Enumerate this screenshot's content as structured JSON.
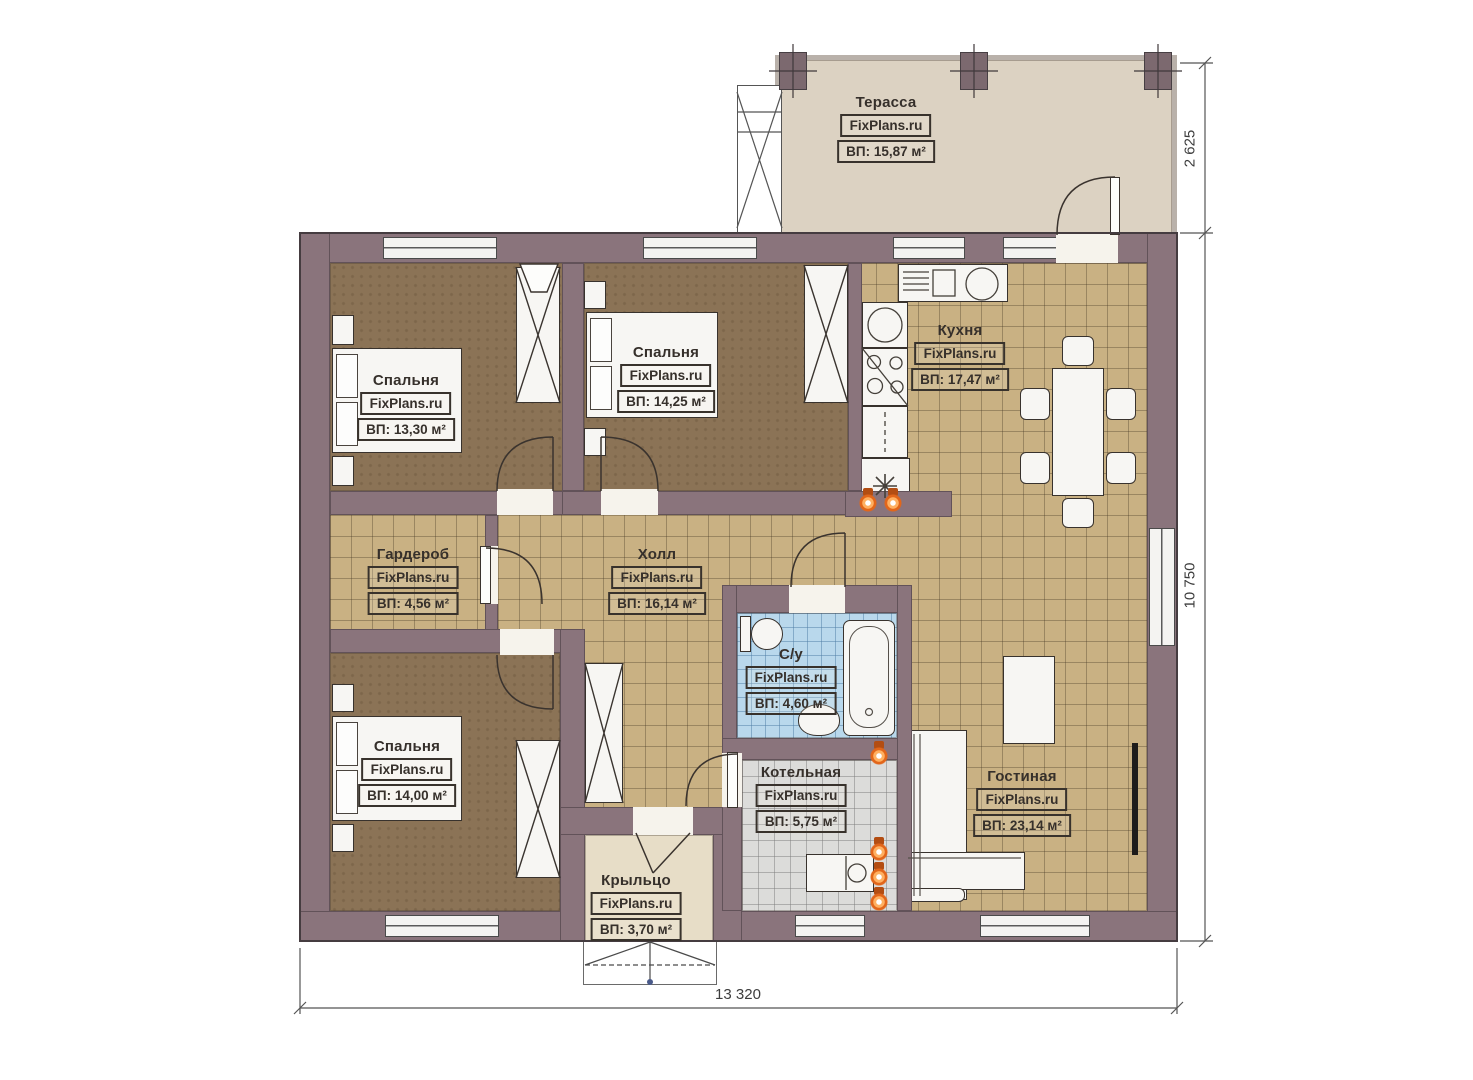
{
  "watermark": "FixPlans.ru",
  "rooms": {
    "terrace": {
      "name": "Терасса",
      "area": "ВП: 15,87 м²"
    },
    "bedroom_tl": {
      "name": "Спальня",
      "area": "ВП: 13,30 м²"
    },
    "bedroom_tm": {
      "name": "Спальня",
      "area": "ВП: 14,25 м²"
    },
    "kitchen": {
      "name": "Кухня",
      "area": "ВП: 17,47 м²"
    },
    "wardrobe": {
      "name": "Гардероб",
      "area": "ВП: 4,56 м²"
    },
    "hall": {
      "name": "Холл",
      "area": "ВП: 16,14 м²"
    },
    "bathroom": {
      "name": "С/у",
      "area": "ВП: 4,60 м²"
    },
    "bedroom_bl": {
      "name": "Спальня",
      "area": "ВП: 14,00 м²"
    },
    "boiler": {
      "name": "Котельная",
      "area": "ВП: 5,75 м²"
    },
    "living": {
      "name": "Гостиная",
      "area": "ВП: 23,14 м²"
    },
    "porch": {
      "name": "Крыльцо",
      "area": "ВП: 3,70 м²"
    }
  },
  "dimensions": {
    "terrace_depth": "2 625",
    "house_depth": "10 750",
    "house_width": "13 320"
  },
  "colors": {
    "wall": "#8a747c",
    "tile_floor": "#c9b183",
    "bedroom_floor": "#8b7356",
    "bathroom_floor": "#b9d8ec",
    "boiler_floor": "#dcdcda",
    "terrace_floor": "#dcd2c2",
    "porch_floor": "#e7ddc7",
    "radiator": "#e2661a"
  }
}
